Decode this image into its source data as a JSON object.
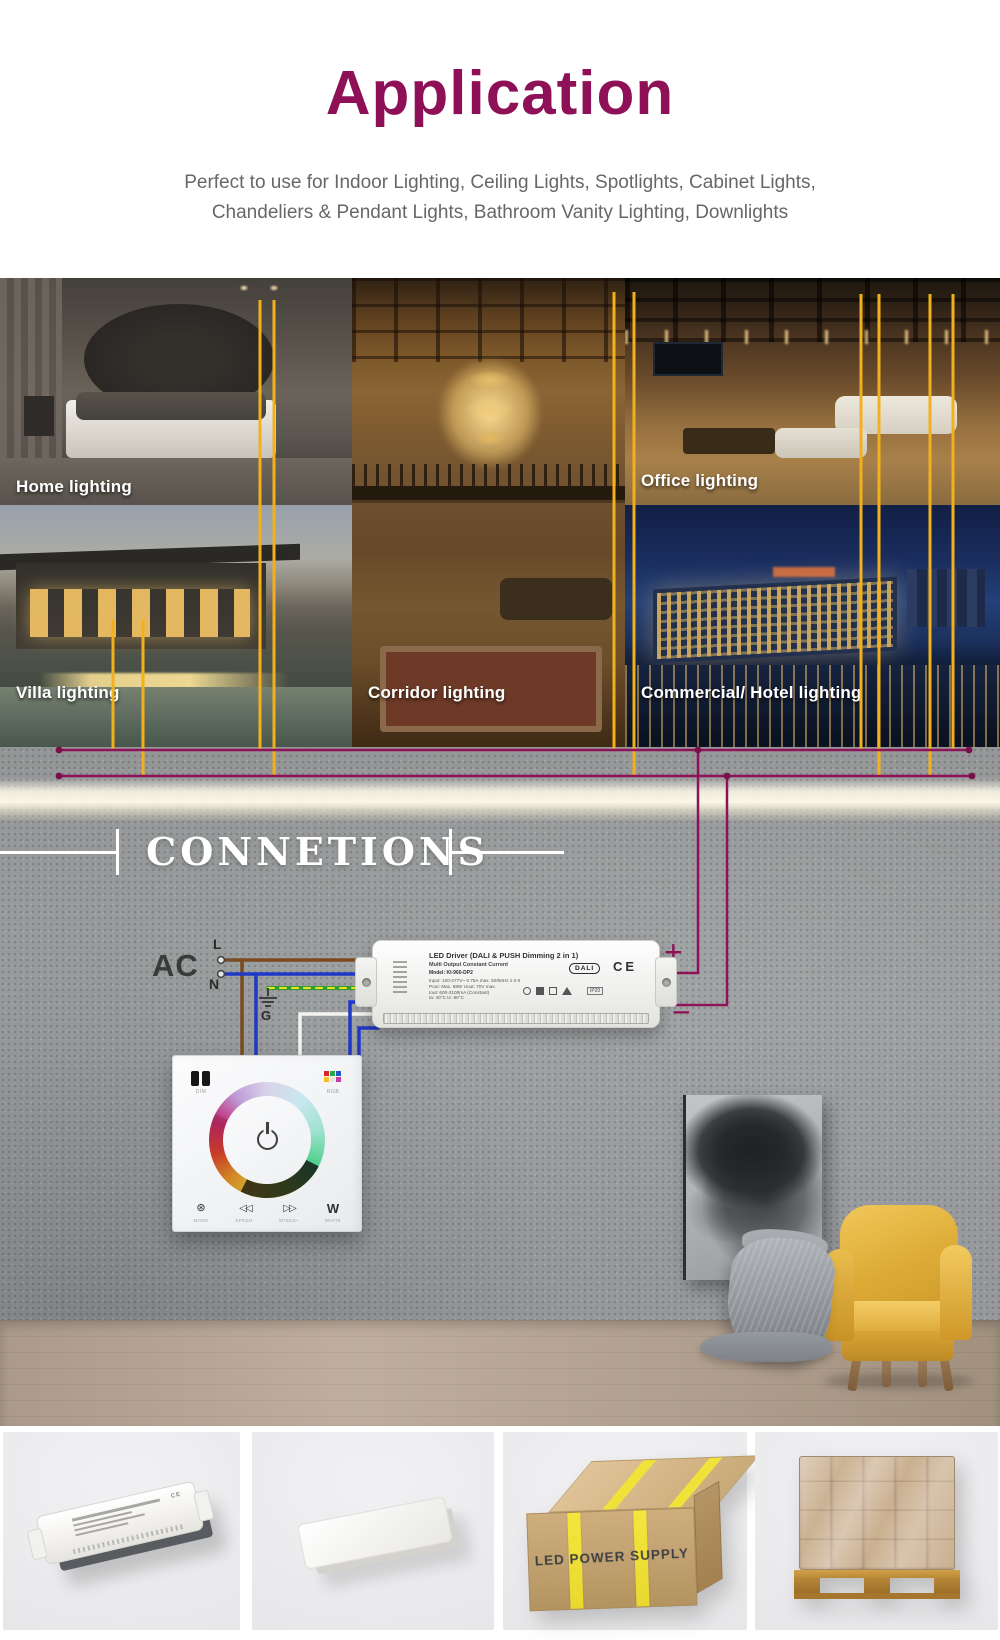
{
  "header": {
    "title": "Application",
    "subtitle_line1": "Perfect to use for Indoor Lighting, Ceiling Lights, Spotlights, Cabinet Lights,",
    "subtitle_line2": "Chandeliers & Pendant Lights, Bathroom Vanity Lighting, Downlights"
  },
  "gallery": {
    "home_label": "Home lighting",
    "office_label": "Office lighting",
    "villa_label": "Villa lighting",
    "corridor_label": "Corridor lighting",
    "hotel_label": "Commercial/ Hotel lighting"
  },
  "connections": {
    "heading": "CONNETIONS",
    "ac_label": "AC",
    "line_label": "L",
    "neutral_label": "N",
    "ground_label": "G",
    "plus_label": "+",
    "minus_label": "−"
  },
  "driver": {
    "title": "LED Driver (DALI & PUSH Dimming 2 in 1)",
    "subtitle": "Multi Output Constant Current",
    "model": "Model: KI-960-DP2",
    "spec_input": "Input: 100-277V~ 0.75A max. 50/60Hz λ 0.9",
    "spec_power": "Pout: Max. 68W   Uout: 70V max.",
    "spec_current": "Iout: 600-2100mA (Constant)",
    "spec_temp": "ta: 40°C   tc: 80°C",
    "dali_mark": "DALI",
    "ce_mark": "CE",
    "ip_mark": "IP20"
  },
  "panel": {
    "dim_label": "DIM",
    "rgb_label": "RGB",
    "mode_glyph": "⊛",
    "rewind_glyph": "◁◁",
    "forward_glyph": "▷▷",
    "white_glyph": "W",
    "mode_label": "MODE",
    "speed_minus_label": "SPEED-",
    "speed_plus_label": "SPEED+",
    "white_label": "WHITE"
  },
  "shipping": {
    "box_text": "LED POWER SUPPLY"
  },
  "colors": {
    "accent_magenta": "#8e1257",
    "line_yellow": "#f2b11c",
    "chair_yellow": "#ddab35",
    "wall_gray": "#9b9e9f"
  }
}
